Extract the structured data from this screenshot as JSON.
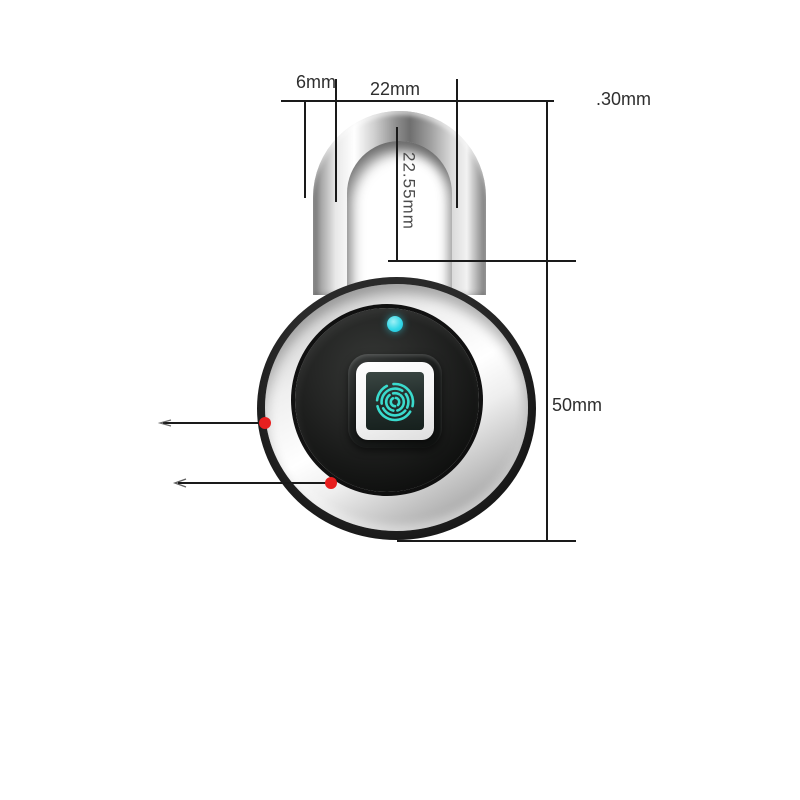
{
  "annotations": {
    "shackle_thickness_label": "6mm",
    "shackle_inner_width_label": "22mm",
    "top_right_label": ".30mm",
    "shackle_inner_height_label": "22.55mm",
    "body_height_label": "50mm"
  },
  "icons": {
    "fingerprint": "fingerprint-icon",
    "led": "led-indicator-dot",
    "markers": "red-marker-dot",
    "leader_arrows": "leader-arrow-icon"
  },
  "colors": {
    "background": "#ffffff",
    "dimension_line": "#1a1a1a",
    "label_text": "#2e2e2e",
    "rotated_label_text": "#4c4c4c",
    "marker_dot": "#e81f1f",
    "led": "#35d8e8",
    "fingerprint_glyph": "#3adbcd",
    "screen_teal_dark": "#273230"
  }
}
